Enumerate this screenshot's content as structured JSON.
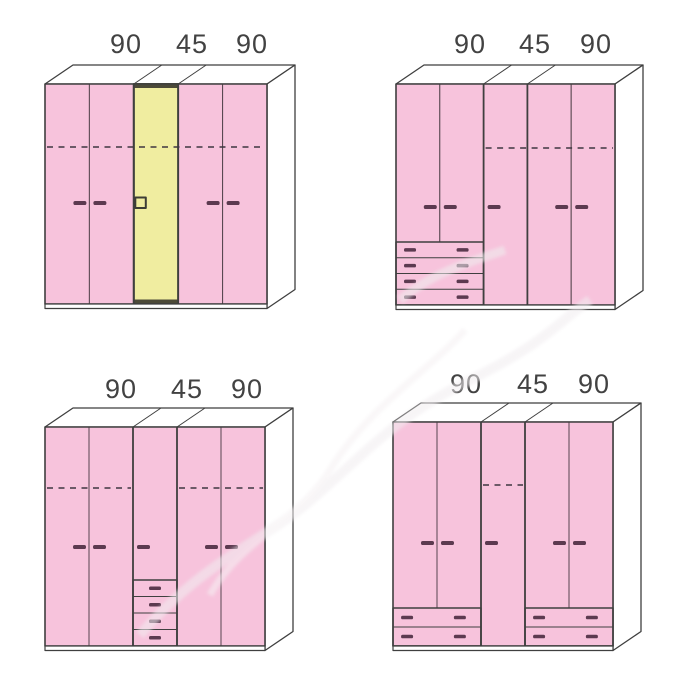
{
  "diagram": {
    "description": "Four wardrobe configuration drawings in a 2x2 grid, each composed of 90 / 45 / 90 cm sections",
    "colors": {
      "door_pink": "#f7c3dc",
      "door_yellow": "#f0eda0",
      "yellow_trim": "#4c4a38",
      "door_edge": "#57464f",
      "frame": "#3f3f3f",
      "handle": "#5c3a50",
      "dash": "#3f3640",
      "label_text": "#424242",
      "face_white": "#ffffff"
    },
    "wardrobes": [
      {
        "id": "top-left",
        "dimension_labels": [
          "90",
          "45",
          "90"
        ],
        "label_positions": [
          126,
          192,
          252
        ],
        "label_baseline": 53,
        "front": {
          "x": 45,
          "y": 84,
          "width": 222,
          "height": 220
        },
        "depth": {
          "dx": 28,
          "dy": 19
        },
        "doors": [
          {
            "color": "pink",
            "handle": "right"
          },
          {
            "color": "pink",
            "handle": "left"
          },
          {
            "color": "yellow",
            "handle": "square"
          },
          {
            "color": "pink",
            "handle": "right"
          },
          {
            "color": "pink",
            "handle": "left"
          }
        ],
        "handle_y": 203,
        "dash_y": 147,
        "dash_door_ranges": [
          [
            0,
            4
          ]
        ],
        "drawer_units": []
      },
      {
        "id": "top-right",
        "dimension_labels": [
          "90",
          "45",
          "90"
        ],
        "label_positions": [
          470,
          535,
          596
        ],
        "label_baseline": 53,
        "front": {
          "x": 396,
          "y": 84,
          "width": 219,
          "height": 221
        },
        "depth": {
          "dx": 28,
          "dy": 19
        },
        "doors": [
          {
            "color": "pink",
            "handle": "right"
          },
          {
            "color": "pink",
            "handle": "left"
          },
          {
            "color": "pink",
            "handle": "left"
          },
          {
            "color": "pink",
            "handle": "right"
          },
          {
            "color": "pink",
            "handle": "left"
          }
        ],
        "handle_y": 207,
        "dash_y": 148,
        "dash_door_ranges": [
          [
            2,
            4
          ]
        ],
        "drawer_units": [
          {
            "door_from": 0,
            "door_to": 1,
            "rows": 4,
            "top": 242,
            "handles_per_row": 2
          }
        ]
      },
      {
        "id": "bottom-left",
        "dimension_labels": [
          "90",
          "45",
          "90"
        ],
        "label_positions": [
          121,
          187,
          247
        ],
        "label_baseline": 398,
        "front": {
          "x": 45,
          "y": 427,
          "width": 220,
          "height": 219
        },
        "depth": {
          "dx": 28,
          "dy": 19
        },
        "doors": [
          {
            "color": "pink",
            "handle": "right"
          },
          {
            "color": "pink",
            "handle": "left"
          },
          {
            "color": "pink",
            "handle": "left"
          },
          {
            "color": "pink",
            "handle": "right"
          },
          {
            "color": "pink",
            "handle": "left"
          }
        ],
        "handle_y": 547,
        "dash_y": 488,
        "dash_door_ranges": [
          [
            0,
            1
          ],
          [
            3,
            4
          ]
        ],
        "drawer_units": [
          {
            "door_from": 2,
            "door_to": 2,
            "rows": 4,
            "top": 580,
            "handles_per_row": 1
          }
        ]
      },
      {
        "id": "bottom-right",
        "dimension_labels": [
          "90",
          "45",
          "90"
        ],
        "label_positions": [
          466,
          533,
          594
        ],
        "label_baseline": 393,
        "front": {
          "x": 393,
          "y": 422,
          "width": 220,
          "height": 224
        },
        "depth": {
          "dx": 28,
          "dy": 19
        },
        "doors": [
          {
            "color": "pink",
            "handle": "right"
          },
          {
            "color": "pink",
            "handle": "left"
          },
          {
            "color": "pink",
            "handle": "left"
          },
          {
            "color": "pink",
            "handle": "right"
          },
          {
            "color": "pink",
            "handle": "left"
          }
        ],
        "handle_y": 543,
        "dash_y": 485,
        "dash_door_ranges": [
          [
            2,
            2
          ]
        ],
        "drawer_units": [
          {
            "door_from": 0,
            "door_to": 1,
            "rows": 2,
            "top": 608,
            "handles_per_row": 2
          },
          {
            "door_from": 3,
            "door_to": 4,
            "rows": 2,
            "top": 608,
            "handles_per_row": 2
          }
        ]
      }
    ]
  }
}
